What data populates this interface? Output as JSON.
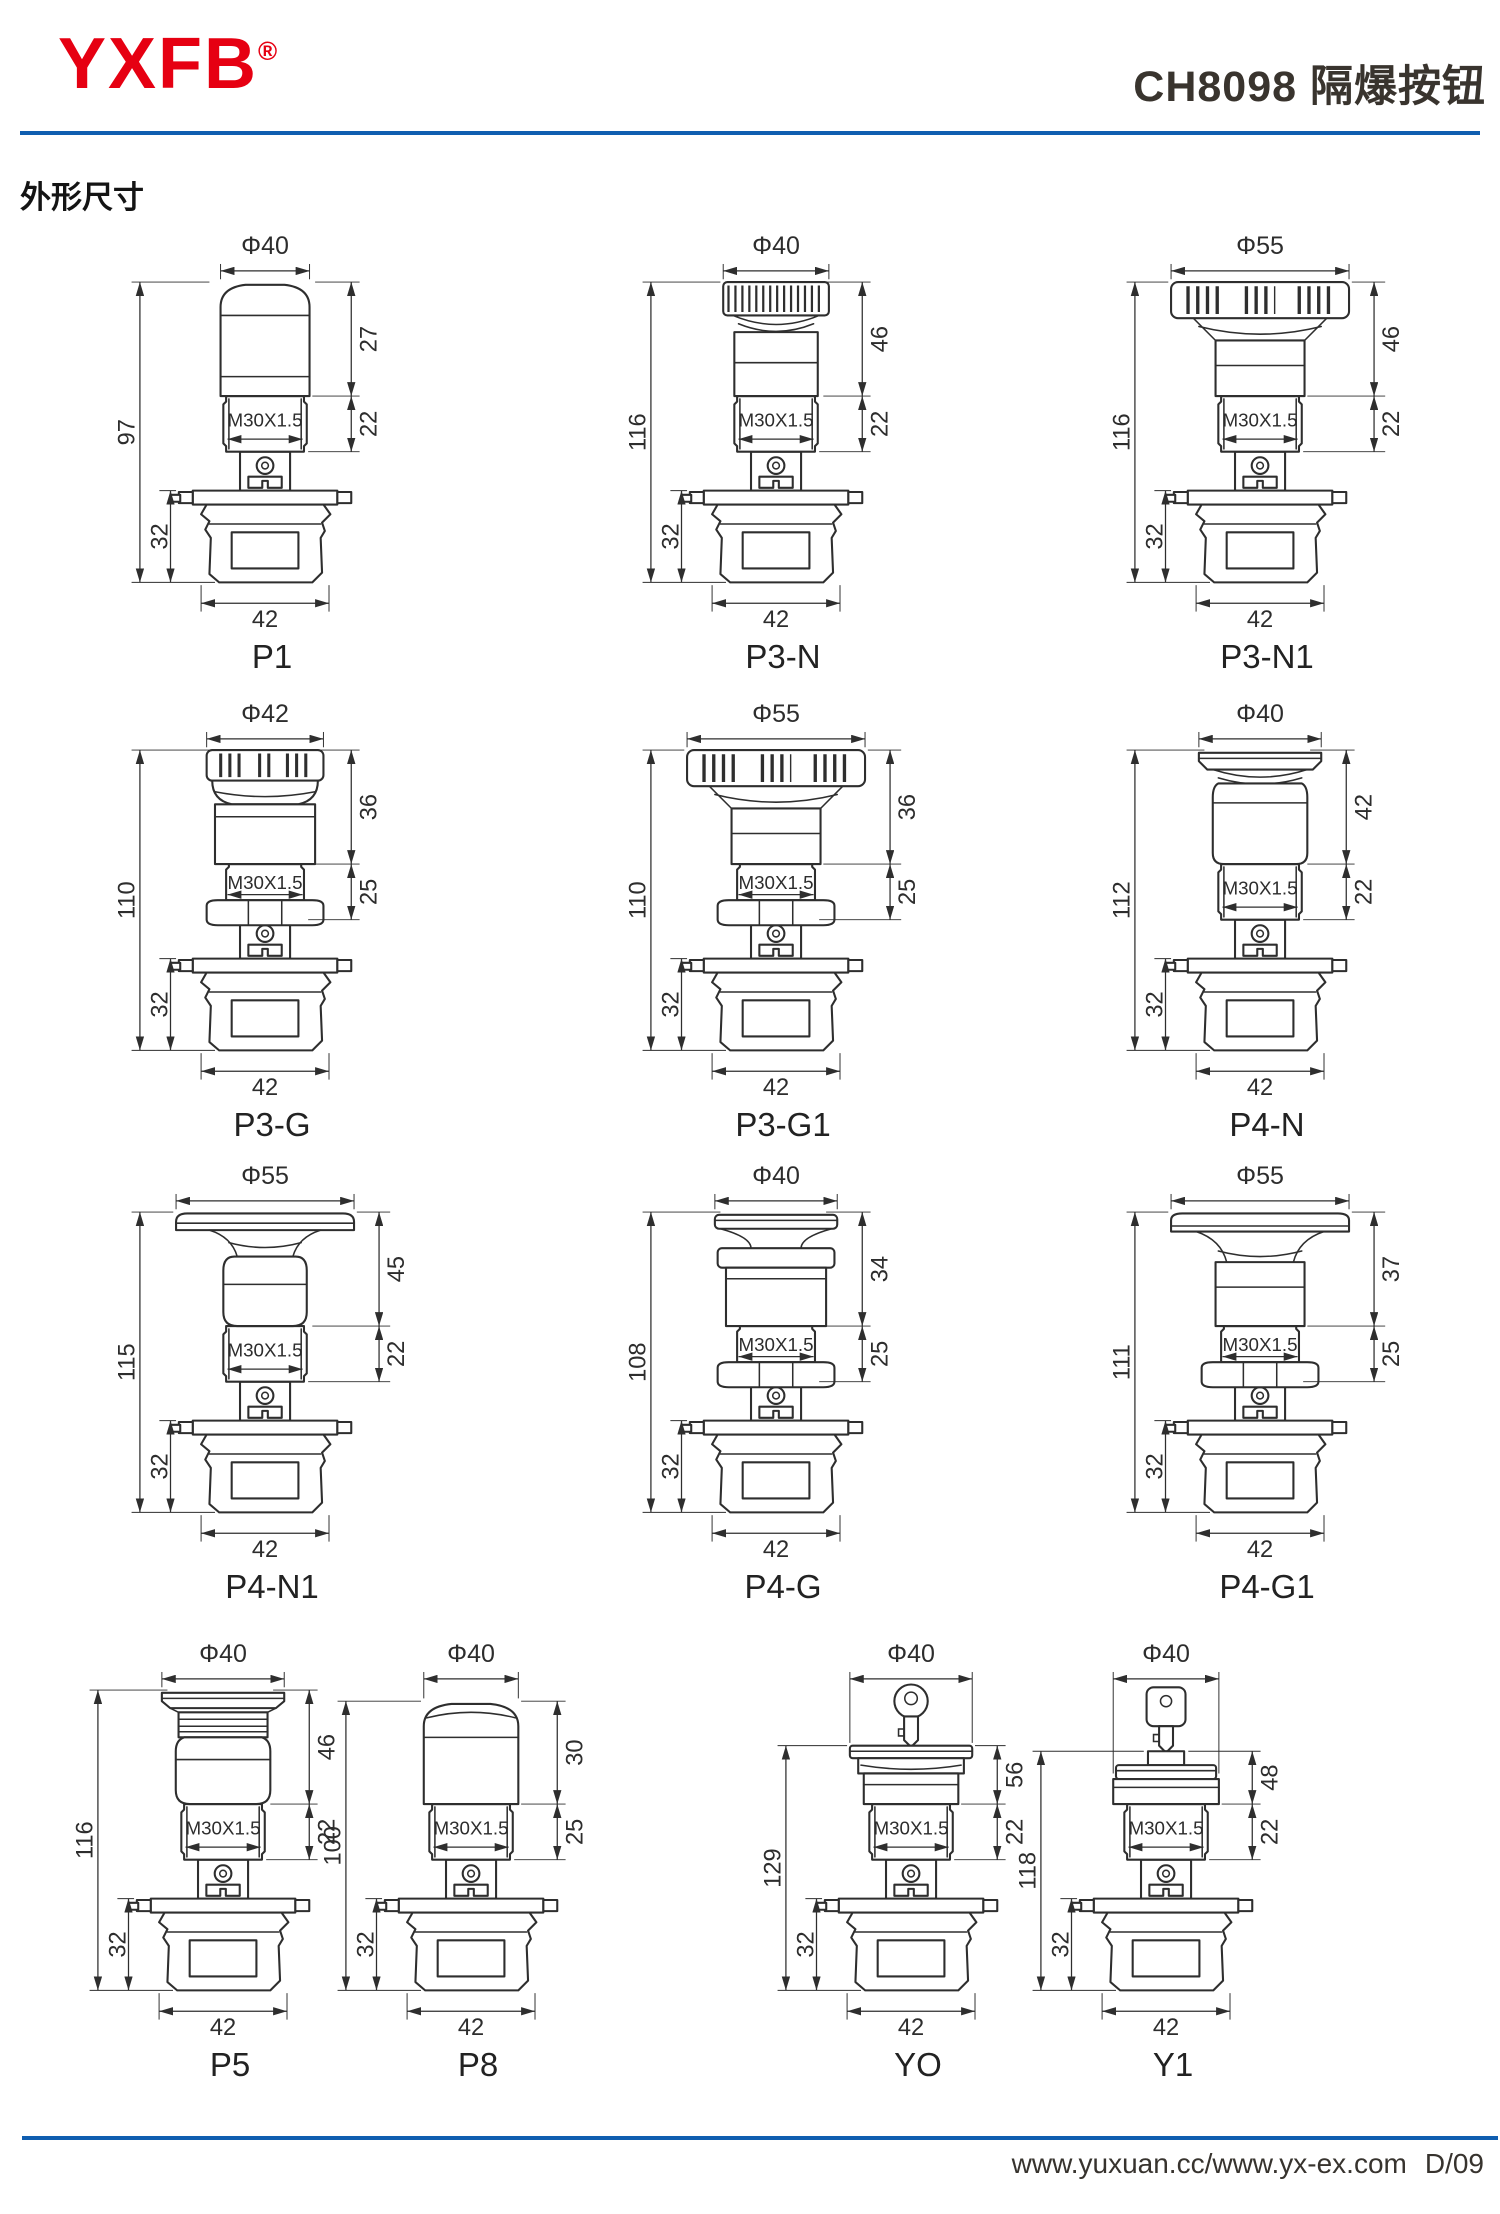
{
  "header": {
    "logo": "YXFB",
    "registered": "®",
    "title": "CH8098 隔爆按钮"
  },
  "section_title": "外形尺寸",
  "colors": {
    "brand_red": "#e60012",
    "rule_blue": "#0f5eb0",
    "ink": "#2e2e2e"
  },
  "figures": [
    {
      "name": "P1",
      "dia": "Φ40",
      "head_h": "27",
      "thread_h": "22",
      "total_h": "97",
      "lower_h": "32",
      "base_w": "42",
      "thread_label": "M30X1.5",
      "head_style": "dome-button"
    },
    {
      "name": "P3-N",
      "dia": "Φ40",
      "head_h": "46",
      "thread_h": "22",
      "total_h": "116",
      "lower_h": "32",
      "base_w": "42",
      "thread_label": "M30X1.5",
      "head_style": "knurled-mushroom"
    },
    {
      "name": "P3-N1",
      "dia": "Φ55",
      "head_h": "46",
      "thread_h": "22",
      "total_h": "116",
      "lower_h": "32",
      "base_w": "42",
      "thread_label": "M30X1.5",
      "head_style": "slotted-wide-mushroom"
    },
    {
      "name": "P3-G",
      "dia": "Φ42",
      "head_h": "36",
      "thread_h": "25",
      "total_h": "110",
      "lower_h": "32",
      "base_w": "42",
      "thread_label": "M30X1.5",
      "head_style": "slotted-cap-with-nut"
    },
    {
      "name": "P3-G1",
      "dia": "Φ55",
      "head_h": "36",
      "thread_h": "25",
      "total_h": "110",
      "lower_h": "32",
      "base_w": "42",
      "thread_label": "M30X1.5",
      "head_style": "slotted-wide-mushroom-with-nut"
    },
    {
      "name": "P4-N",
      "dia": "Φ40",
      "head_h": "42",
      "thread_h": "22",
      "total_h": "112",
      "lower_h": "32",
      "base_w": "42",
      "thread_label": "M30X1.5",
      "head_style": "flanged-cylinder"
    },
    {
      "name": "P4-N1",
      "dia": "Φ55",
      "head_h": "45",
      "thread_h": "22",
      "total_h": "115",
      "lower_h": "32",
      "base_w": "42",
      "thread_label": "M30X1.5",
      "head_style": "flat-wide-mushroom"
    },
    {
      "name": "P4-G",
      "dia": "Φ40",
      "head_h": "34",
      "thread_h": "25",
      "total_h": "108",
      "lower_h": "32",
      "base_w": "42",
      "thread_label": "M30X1.5",
      "head_style": "spool-button-with-nut"
    },
    {
      "name": "P4-G1",
      "dia": "Φ55",
      "head_h": "37",
      "thread_h": "25",
      "total_h": "111",
      "lower_h": "32",
      "base_w": "42",
      "thread_label": "M30X1.5",
      "head_style": "wide-mushroom-with-nut"
    },
    {
      "name": "P5",
      "dia": "Φ40",
      "head_h": "46",
      "thread_h": "22",
      "total_h": "116",
      "lower_h": "32",
      "base_w": "42",
      "thread_label": "M30X1.5",
      "head_style": "flanged-ring-cylinder"
    },
    {
      "name": "P8",
      "dia": "Φ40",
      "head_h": "30",
      "thread_h": "25",
      "total_h": "100",
      "lower_h": "32",
      "base_w": "42",
      "thread_label": "M30X1.5",
      "head_style": "round-button"
    },
    {
      "name": "YO",
      "dia": "Φ40",
      "head_h": "56",
      "thread_h": "22",
      "total_h": "129",
      "lower_h": "32",
      "base_w": "42",
      "thread_label": "M30X1.5",
      "head_style": "key-switch-round-bow"
    },
    {
      "name": "Y1",
      "dia": "Φ40",
      "head_h": "48",
      "thread_h": "22",
      "total_h": "118",
      "lower_h": "32",
      "base_w": "42",
      "thread_label": "M30X1.5",
      "head_style": "key-switch-square-bow"
    }
  ],
  "footer": {
    "urls": "www.yuxuan.cc/www.yx-ex.com",
    "page": "D/09"
  }
}
